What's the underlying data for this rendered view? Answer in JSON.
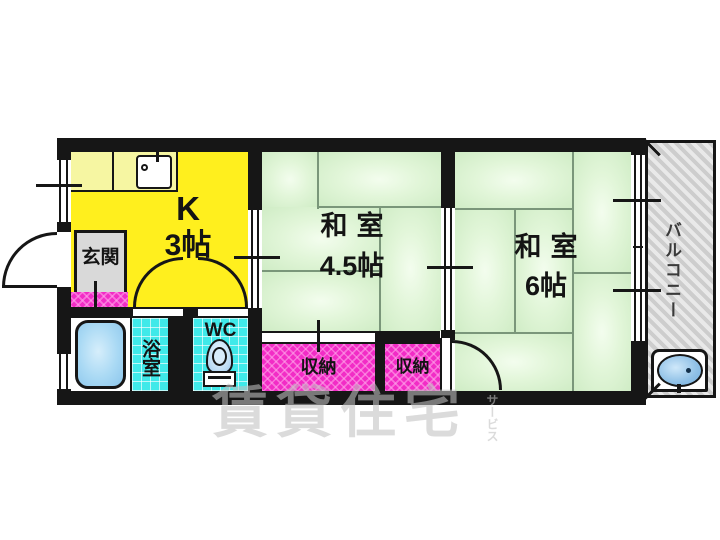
{
  "rooms": {
    "kitchen": {
      "type": "K",
      "size": "3帖"
    },
    "japanese_room_45": {
      "type": "和室",
      "size": "4.5帖"
    },
    "japanese_room_6": {
      "type": "和室",
      "size": "6帖"
    },
    "entrance": {
      "label": "玄関"
    },
    "bath": {
      "label": "浴室"
    },
    "toilet": {
      "label": "WC"
    },
    "closet_a": {
      "label": "収納"
    },
    "closet_b": {
      "label": "収納"
    },
    "balcony": {
      "label": "バルコニー"
    }
  },
  "watermark": {
    "main": "賃貸住宅",
    "sub": "サービス"
  },
  "colors": {
    "wall": "#161616",
    "kitchen_fill": "#ffef1e",
    "counter_fill": "#f6f6a2",
    "tatami_fill": "#ddf4d4",
    "tile_fill": "#3fe9e9",
    "closet_fill": "#f22cc6",
    "entrance_fill": "#d9d9d9",
    "balcony_fill": "#e6e6e6",
    "water_fill": "#9fd2f0"
  }
}
